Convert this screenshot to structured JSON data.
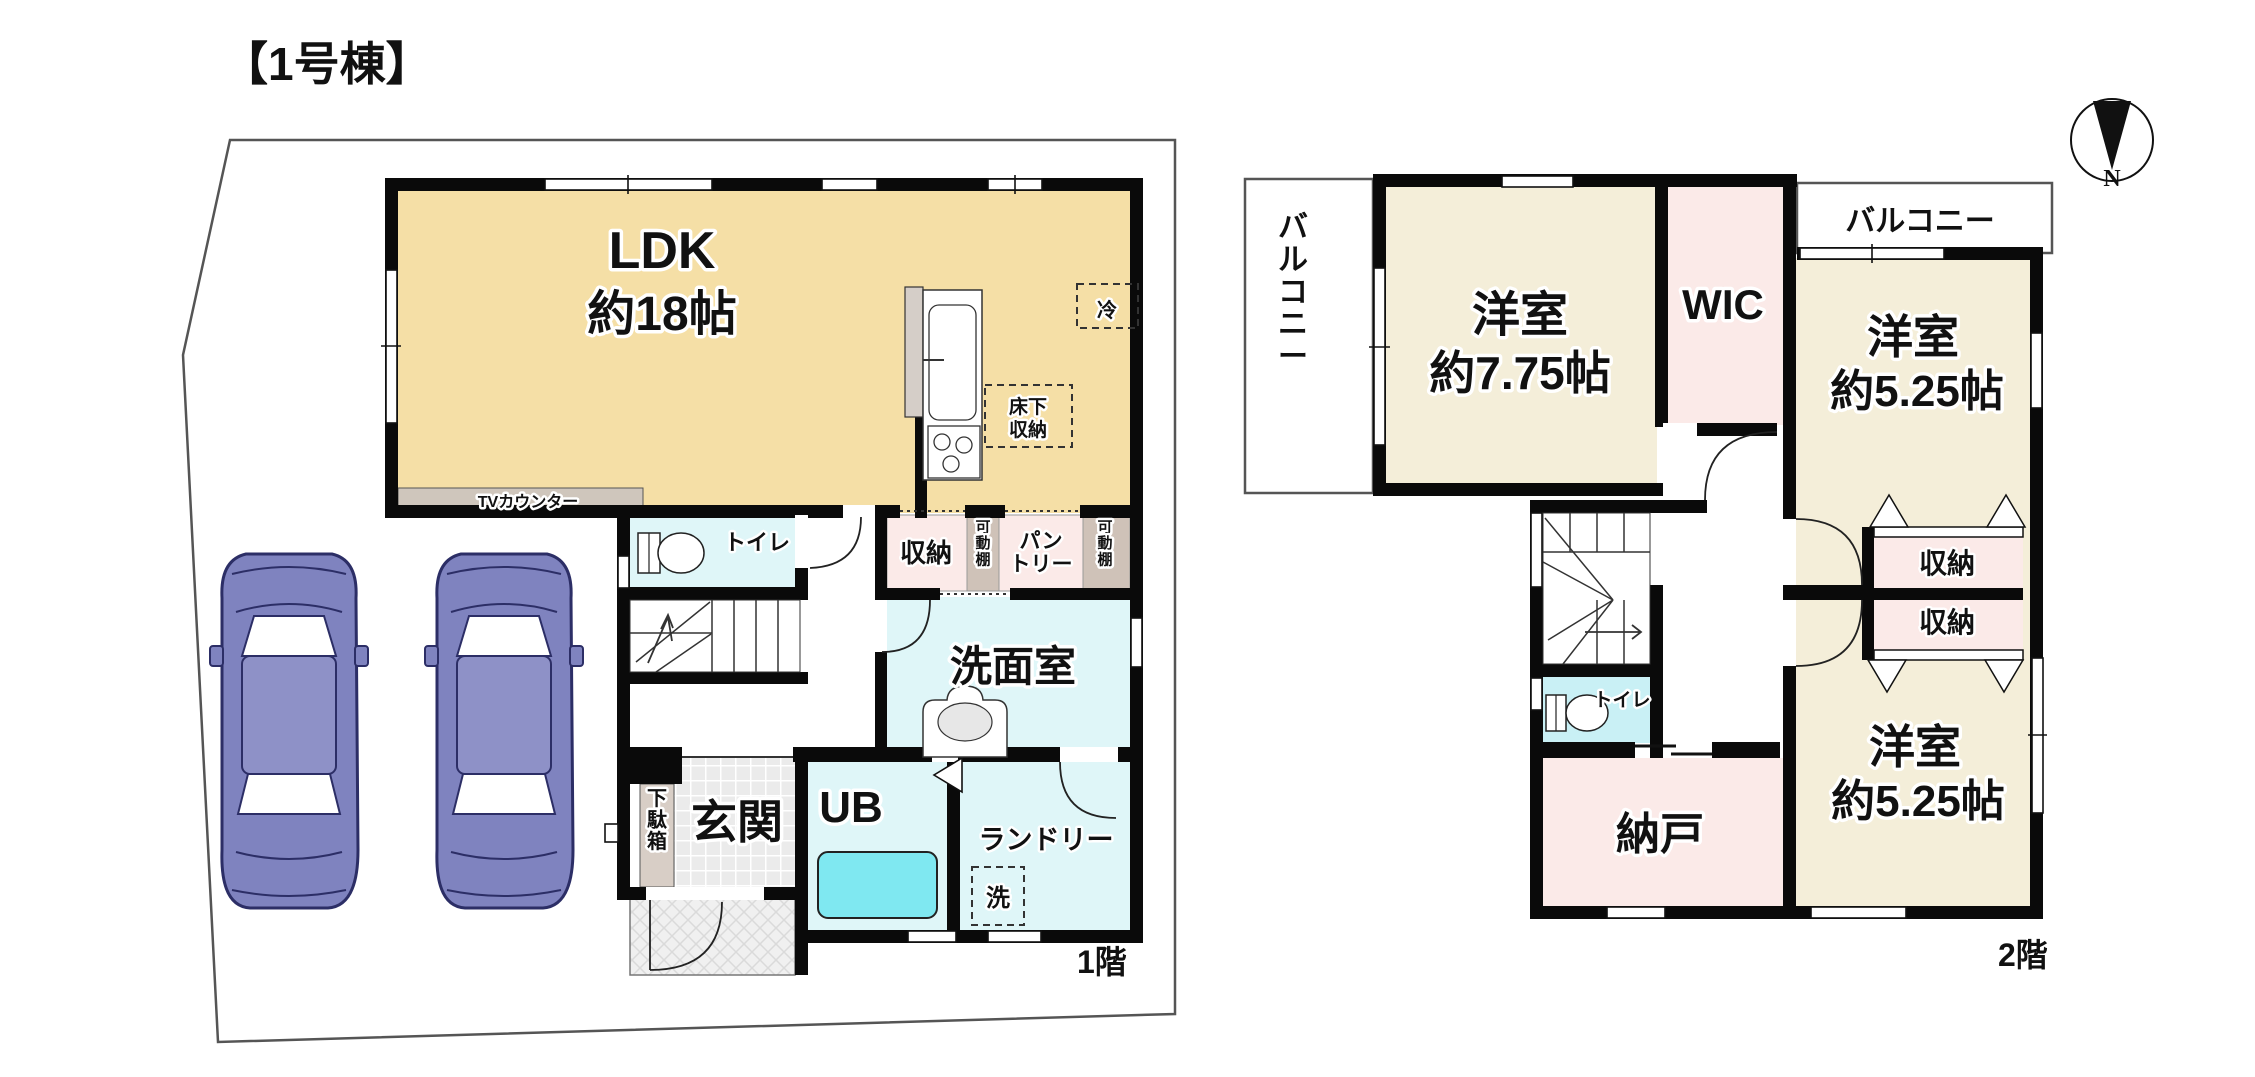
{
  "title": "【1号棟】",
  "compass": {
    "north_label": "N"
  },
  "colors": {
    "wall": "#0a0a0a",
    "ldk_floor": "#F5DFA6",
    "bedroom_floor": "#F4EED9",
    "closet_pink": "#FBEAE8",
    "wet_cyan": "#DFF6F8",
    "toilet2_cyan": "#C9F0F5",
    "bathtub": "#7FE8F1",
    "counter_tan": "#CFC6BC",
    "car_body": "#7F83BF",
    "site_line": "#555555"
  },
  "floor1": {
    "floor_label": "1階",
    "labels": {
      "ldk_line1": "LDK",
      "ldk_line2": "約18帖",
      "tv_counter": "TVカウンター",
      "toilet": "トイレ",
      "storage": "収納",
      "movable_shelf_1": "可動棚",
      "pantry_line1": "パン",
      "pantry_line2": "トリー",
      "movable_shelf_2": "可動棚",
      "underfloor_line1": "床下",
      "underfloor_line2": "収納",
      "fridge": "冷",
      "washroom": "洗面室",
      "entrance": "玄関",
      "shoe_box": "下駄箱",
      "unit_bath": "UB",
      "laundry": "ランドリー",
      "washer": "洗"
    }
  },
  "floor2": {
    "floor_label": "2階",
    "labels": {
      "balcony_left": "バルコニー",
      "balcony_top": "バルコニー",
      "bedroom1_line1": "洋室",
      "bedroom1_line2": "約7.75帖",
      "wic": "WIC",
      "bedroom2_line1": "洋室",
      "bedroom2_line2": "約5.25帖",
      "storage_upper": "収納",
      "storage_lower": "収納",
      "bedroom3_line1": "洋室",
      "bedroom3_line2": "約5.25帖",
      "toilet": "トイレ",
      "storeroom": "納戸"
    }
  }
}
